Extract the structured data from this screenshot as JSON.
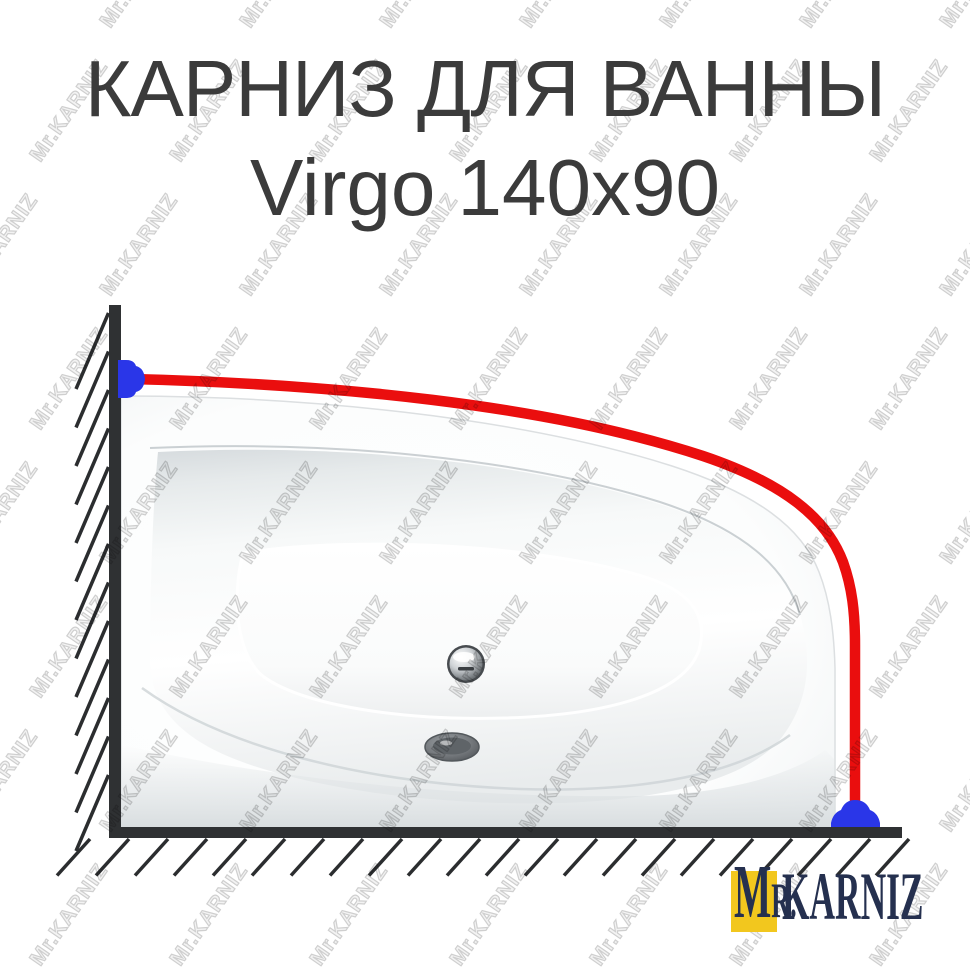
{
  "title": {
    "line1": "КАРНИЗ ДЛЯ ВАННЫ",
    "line2": "Virgo 140x90",
    "product_type": "КАРНИЗ ДЛЯ ВАННЫ",
    "model": "Virgo",
    "size": "140x90"
  },
  "watermark": {
    "text": "Mr.KARNIZ"
  },
  "logo": {
    "m": "M",
    "r": "R.",
    "name": "KARNIZ"
  },
  "colors": {
    "background": "#ffffff",
    "title_text": "#3b3b3b",
    "rod_red": "#ea0e0e",
    "bracket_blue": "#2a36e8",
    "wall_dark": "#2f3133",
    "hatch_dark": "#2b2d2f",
    "watermark_gray": "#cfcfcf",
    "logo_navy": "#25304f",
    "logo_yellow": "#f2c71e",
    "tub_shadow_gray": "#dfe3e4"
  }
}
